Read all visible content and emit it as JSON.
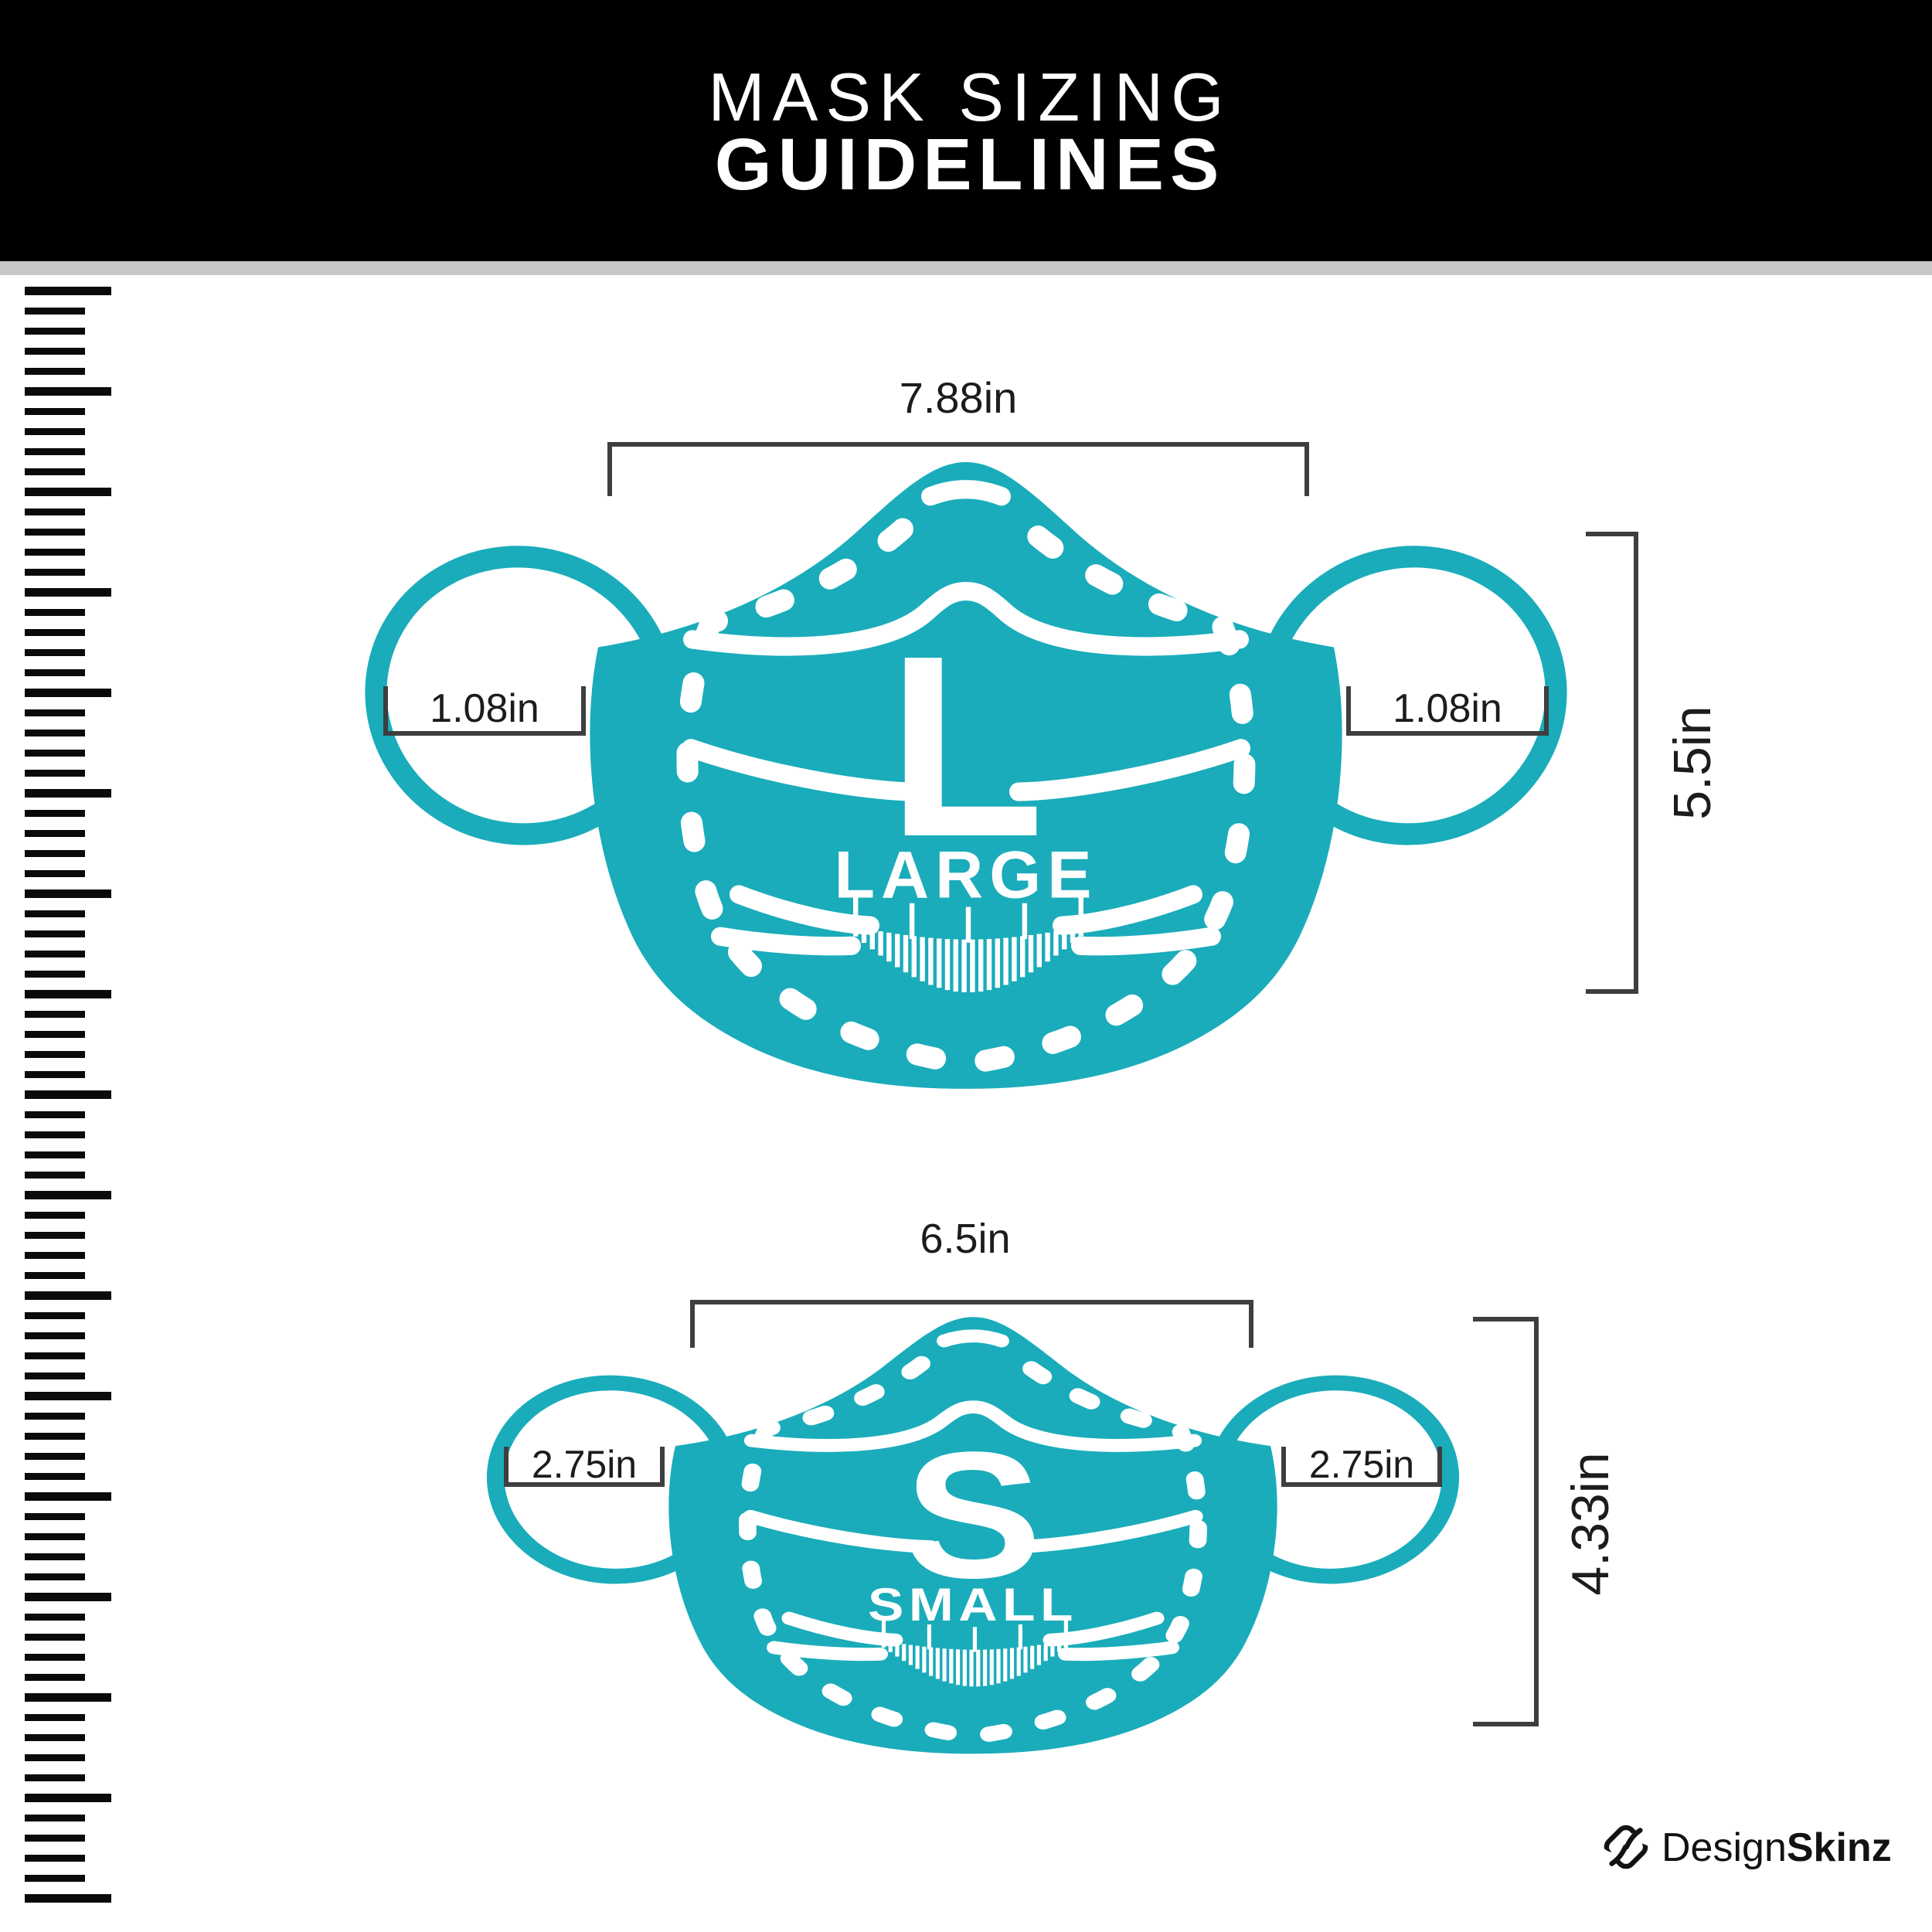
{
  "header": {
    "title_line1": "MASK SIZING",
    "title_line2": "GUIDELINES"
  },
  "masks": [
    {
      "size_letter": "L",
      "size_name": "LARGE",
      "width_label": "7.88in",
      "ear_label_left": "1.08in",
      "ear_label_right": "1.08in",
      "height_label": "5.5in"
    },
    {
      "size_letter": "S",
      "size_name": "SMALL",
      "width_label": "6.5in",
      "ear_label_left": "2.75in",
      "ear_label_right": "2.75in",
      "height_label": "4.33in"
    }
  ],
  "brand": {
    "name_regular": "Design",
    "name_bold": "Skinz"
  },
  "colors": {
    "mask_teal": "#1aacba",
    "header_bg": "#000000",
    "divider_gray": "#c8c8c8",
    "bracket_gray": "#3e3e3e",
    "ink": "#111111"
  },
  "ruler": {
    "tick_count": 81,
    "major_every": 5
  }
}
